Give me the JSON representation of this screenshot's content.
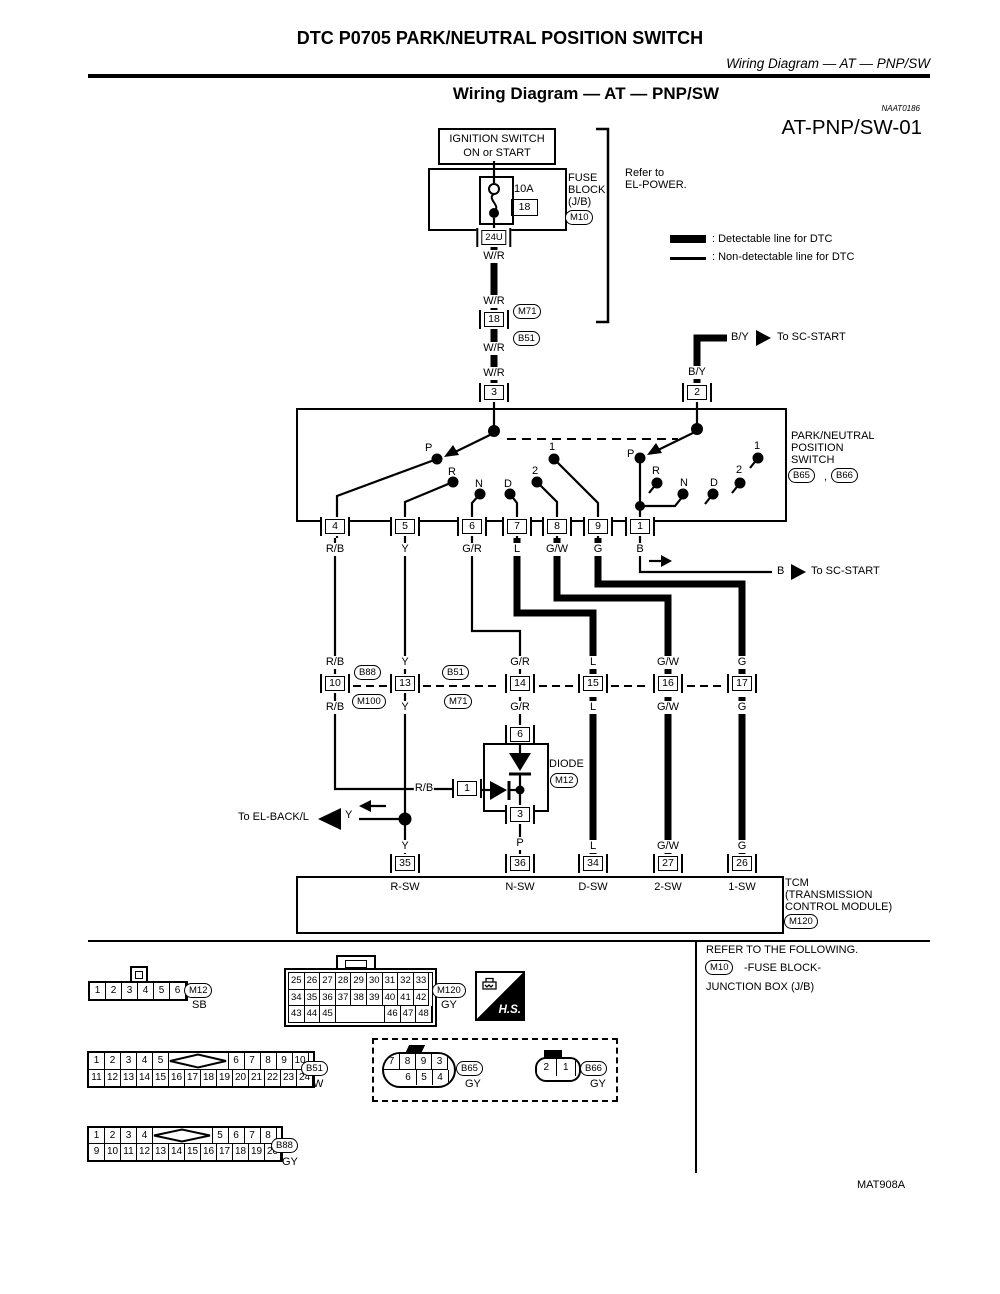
{
  "colors": {
    "ink": "#000000",
    "paper": "#ffffff"
  },
  "header": {
    "dtc_title": "DTC P0705 PARK/NEUTRAL POSITION SWITCH",
    "running_title": "Wiring Diagram — AT — PNP/SW",
    "section_title": "Wiring Diagram — AT — PNP/SW",
    "doc_code": "NAAT0186",
    "diagram_id": "AT-PNP/SW-01"
  },
  "legend": {
    "detectable": ": Detectable line for DTC",
    "non_detectable": ": Non-detectable line for DTC"
  },
  "power": {
    "ignition_l1": "IGNITION SWITCH",
    "ignition_l2": "ON or START",
    "fuse_rating": "10A",
    "fuse_number": "18",
    "fuse_block_l1": "FUSE",
    "fuse_block_l2": "BLOCK",
    "fuse_block_l3": "(J/B)",
    "connector_m10": "M10",
    "refer_l1": "Refer to",
    "refer_l2": "EL-POWER.",
    "terminal_24u": "24U",
    "terminal_18": "18",
    "conn_m71": "M71",
    "conn_b51": "B51",
    "terminal_3": "3",
    "terminal_2": "2"
  },
  "wires": {
    "wr": "W/R",
    "by": "B/Y",
    "rb": "R/B",
    "y": "Y",
    "gr": "G/R",
    "l": "L",
    "gw": "G/W",
    "g": "G",
    "b": "B",
    "p": "P"
  },
  "destinations": {
    "sc_start": "To SC-START",
    "el_backl": "To EL-BACK/L"
  },
  "pnp": {
    "label_l1": "PARK/NEUTRAL",
    "label_l2": "POSITION",
    "label_l3": "SWITCH",
    "conn_b65": "B65",
    "sep": ",",
    "conn_b66": "B66",
    "contacts": {
      "p": "P",
      "r": "R",
      "n": "N",
      "d": "D",
      "two": "2",
      "one": "1"
    },
    "terminals": [
      "4",
      "5",
      "6",
      "7",
      "8",
      "9",
      "1"
    ]
  },
  "mid": {
    "terminals": [
      "10",
      "13",
      "14",
      "15",
      "16",
      "17"
    ],
    "conn_b88": "B88",
    "conn_m100": "M100",
    "conn_b51": "B51",
    "conn_m71": "M71"
  },
  "diode": {
    "label": "DIODE",
    "conn": "M12",
    "t_top": "6",
    "t_left": "1",
    "t_bottom": "3"
  },
  "tcm": {
    "pins": [
      {
        "num": "35",
        "wire": "Y",
        "name": "R-SW"
      },
      {
        "num": "36",
        "wire": "P",
        "name": "N-SW"
      },
      {
        "num": "34",
        "wire": "L",
        "name": "D-SW"
      },
      {
        "num": "27",
        "wire": "G/W",
        "name": "2-SW"
      },
      {
        "num": "26",
        "wire": "G",
        "name": "1-SW"
      }
    ],
    "l1": "TCM",
    "l2": "(TRANSMISSION",
    "l3": "CONTROL MODULE)",
    "conn": "M120"
  },
  "refer": {
    "l1": "REFER TO THE FOLLOWING.",
    "conn": "M10",
    "l2": "-FUSE BLOCK-",
    "l3": "JUNCTION BOX (J/B)"
  },
  "bottom": {
    "m12": {
      "pins": [
        "1",
        "2",
        "3",
        "4",
        "5",
        "6"
      ],
      "id": "M12",
      "color": "SB"
    },
    "m120": {
      "row1": [
        "25",
        "26",
        "27",
        "28",
        "29",
        "30",
        "31",
        "32",
        "33"
      ],
      "row2": [
        "34",
        "35",
        "36",
        "37",
        "38",
        "39",
        "40",
        "41",
        "42"
      ],
      "row3_left": [
        "43",
        "44",
        "45"
      ],
      "row3_right": [
        "46",
        "47",
        "48"
      ],
      "id": "M120",
      "color": "GY"
    },
    "hs": "H.S.",
    "b51": {
      "row1_left": [
        "1",
        "2",
        "3",
        "4",
        "5"
      ],
      "row1_right": [
        "6",
        "7",
        "8",
        "9",
        "10"
      ],
      "row2": [
        "11",
        "12",
        "13",
        "14",
        "15",
        "16",
        "17",
        "18",
        "19",
        "20",
        "21",
        "22",
        "23",
        "24"
      ],
      "id": "B51",
      "color": "W"
    },
    "b65": {
      "row1": [
        "7",
        "8",
        "9",
        "3"
      ],
      "row2": [
        "6",
        "5",
        "4"
      ],
      "id": "B65",
      "color": "GY"
    },
    "b66": {
      "pins": [
        "2",
        "1"
      ],
      "id": "B66",
      "color": "GY"
    },
    "b88": {
      "row1_left": [
        "1",
        "2",
        "3",
        "4"
      ],
      "row1_right": [
        "5",
        "6",
        "7",
        "8"
      ],
      "row2": [
        "9",
        "10",
        "11",
        "12",
        "13",
        "14",
        "15",
        "16",
        "17",
        "18",
        "19",
        "20"
      ],
      "id": "B88",
      "color": "GY"
    }
  },
  "footer": {
    "code": "MAT908A"
  }
}
